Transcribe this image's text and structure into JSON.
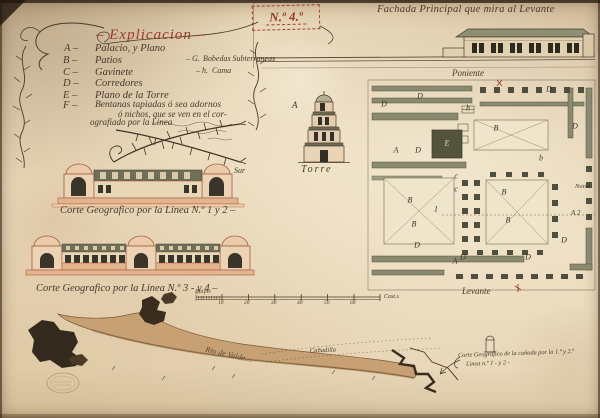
{
  "artwork": {
    "sheet_number": "N.º 4.º",
    "facade_title": "Fachada Principal que mira al Levante"
  },
  "legend": {
    "title": "– Explicacion –",
    "items": [
      {
        "letter": "A –",
        "text": "Palacio, y Plano"
      },
      {
        "letter": "B –",
        "text": "Patios"
      },
      {
        "letter": "C –",
        "text": "Gavinete"
      },
      {
        "letter": "D –",
        "text": "Corredores"
      },
      {
        "letter": "E –",
        "text": "Plano de la Torre"
      },
      {
        "letter": "F –",
        "text": "Bentanas tapiadas ó sea adornos"
      }
    ],
    "item_f_cont1": "ó nichos, que se ven en el cor-",
    "item_f_cont2": "ografiado por la Linea",
    "side_notes": [
      {
        "letter": "– G.",
        "text": "Bobedas Subterraneas"
      },
      {
        "letter": "– h.",
        "text": "Cama"
      }
    ]
  },
  "tower": {
    "label": "Torre",
    "marker": "A"
  },
  "plan": {
    "poniente_label": "Poniente",
    "levante_label": "Levante",
    "norte_label": "Norte",
    "line_mark_right": "A 2",
    "markers": [
      {
        "t": "A",
        "x": 396,
        "y": 150
      },
      {
        "t": "A",
        "x": 455,
        "y": 261
      },
      {
        "t": "E",
        "x": 447,
        "y": 143,
        "light": true
      },
      {
        "t": "B",
        "x": 496,
        "y": 128
      },
      {
        "t": "B",
        "x": 410,
        "y": 200
      },
      {
        "t": "B",
        "x": 414,
        "y": 224
      },
      {
        "t": "B",
        "x": 504,
        "y": 192
      },
      {
        "t": "B",
        "x": 508,
        "y": 220
      },
      {
        "t": "c",
        "x": 456,
        "y": 176
      },
      {
        "t": "c",
        "x": 456,
        "y": 189
      },
      {
        "t": "h",
        "x": 468,
        "y": 108
      },
      {
        "t": "b",
        "x": 541,
        "y": 158
      },
      {
        "t": "1",
        "x": 436,
        "y": 209
      },
      {
        "t": "D",
        "x": 384,
        "y": 104
      },
      {
        "t": "D",
        "x": 420,
        "y": 96
      },
      {
        "t": "D",
        "x": 549,
        "y": 89
      },
      {
        "t": "D",
        "x": 418,
        "y": 150
      },
      {
        "t": "D",
        "x": 575,
        "y": 126
      },
      {
        "t": "D",
        "x": 417,
        "y": 245
      },
      {
        "t": "D",
        "x": 463,
        "y": 257
      },
      {
        "t": "D",
        "x": 528,
        "y": 257
      },
      {
        "t": "D",
        "x": 564,
        "y": 240
      }
    ]
  },
  "sections": {
    "caption_1": "Corte Geografico por la Linea N.º 1 y 2 –",
    "sur_label": "Sur",
    "caption_2": "Corte Geografico por la Linea N.º 3 - y 4 –"
  },
  "scale_bar": {
    "label_left": "Pitipie",
    "label_right": "Cast.s",
    "ticks": [
      "10",
      "20",
      "30",
      "40",
      "50",
      "60"
    ]
  },
  "river": {
    "name": "Rio de Valde…",
    "path_label": "Cañadilla"
  },
  "note": {
    "line1": "Corte Geografico de la cañada por la 1.ª y 2.ª",
    "line2": "Linea n.º 1 - y 2 -"
  }
}
